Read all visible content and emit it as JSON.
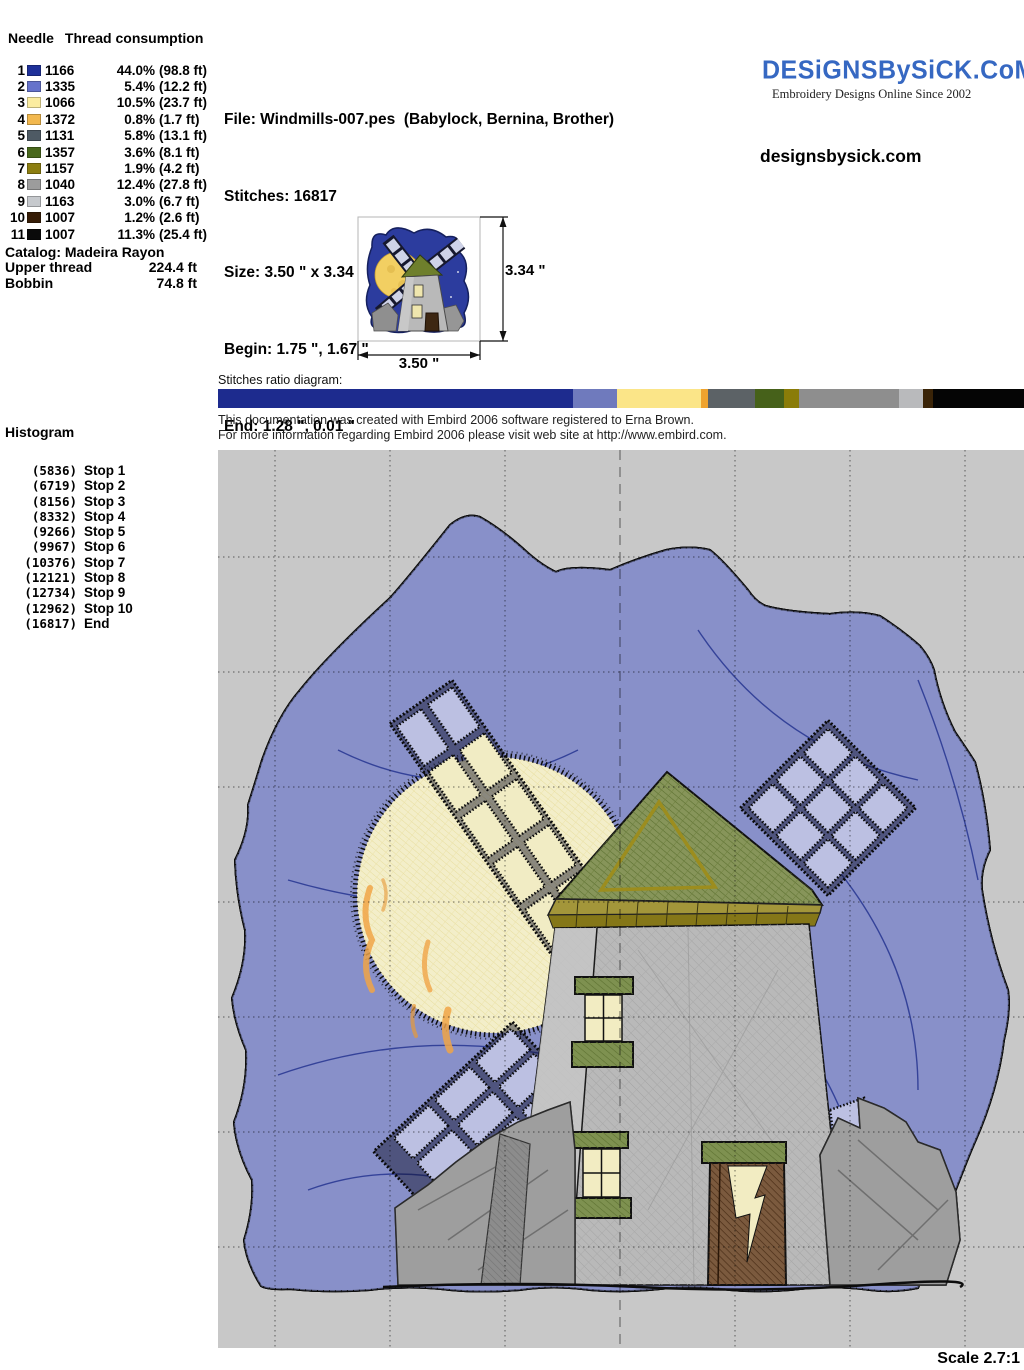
{
  "thread_table": {
    "col1": "Needle",
    "col2": "Thread consumption",
    "rows": [
      {
        "needle": "1",
        "color": "#1e3099",
        "code": "1166",
        "pct": "44.0%",
        "length": "(98.8 ft)"
      },
      {
        "needle": "2",
        "color": "#6673cb",
        "code": "1335",
        "pct": "5.4%",
        "length": "(12.2 ft)"
      },
      {
        "needle": "3",
        "color": "#fbeca0",
        "code": "1066",
        "pct": "10.5%",
        "length": "(23.7 ft)"
      },
      {
        "needle": "4",
        "color": "#f2b84e",
        "code": "1372",
        "pct": "0.8%",
        "length": "(1.7 ft)"
      },
      {
        "needle": "5",
        "color": "#4e5a64",
        "code": "1131",
        "pct": "5.8%",
        "length": "(13.1 ft)"
      },
      {
        "needle": "6",
        "color": "#49681c",
        "code": "1357",
        "pct": "3.6%",
        "length": "(8.1 ft)"
      },
      {
        "needle": "7",
        "color": "#8c7e10",
        "code": "1157",
        "pct": "1.9%",
        "length": "(4.2 ft)"
      },
      {
        "needle": "8",
        "color": "#9c9c9c",
        "code": "1040",
        "pct": "12.4%",
        "length": "(27.8 ft)"
      },
      {
        "needle": "9",
        "color": "#c6c9cd",
        "code": "1163",
        "pct": "3.0%",
        "length": "(6.7 ft)"
      },
      {
        "needle": "10",
        "color": "#361c06",
        "code": "1007",
        "pct": "1.2%",
        "length": "(2.6 ft)"
      },
      {
        "needle": "11",
        "color": "#0a0a0a",
        "code": "1007",
        "pct": "11.3%",
        "length": "(25.4 ft)"
      }
    ]
  },
  "catalog": {
    "title": "Catalog: Madeira Rayon",
    "upper_label": "Upper thread",
    "upper_value": "224.4 ft",
    "bobbin_label": "Bobbin",
    "bobbin_value": "74.8 ft"
  },
  "file_info": {
    "lines": [
      "File: Windmills-007.pes  (Babylock, Bernina, Brother)",
      "Stitches: 16817",
      "Size: 3.50 \" x 3.34 \"",
      "Begin: 1.75 \", 1.67 \"",
      "End: 1.28 \", 0.01 \"",
      "Start needle: 1",
      "Colors: 11/11 , Stops: 10",
      "Date: 12/31/2007"
    ]
  },
  "branding": {
    "logo_text": "DESiGNSBySiCK.CoM",
    "tagline": "Embroidery Designs Online Since 2002",
    "site": "designsbysick.com",
    "logo_color": "#3668c2"
  },
  "preview": {
    "height_label": "3.34 \"",
    "width_label": "3.50 \""
  },
  "ratio": {
    "label": "Stitches ratio diagram:",
    "segments": [
      {
        "color": "#1d2b8e",
        "pct": 44.0
      },
      {
        "color": "#6f7abd",
        "pct": 5.4
      },
      {
        "color": "#fbe588",
        "pct": 10.5
      },
      {
        "color": "#efa32f",
        "pct": 0.8
      },
      {
        "color": "#5c6266",
        "pct": 5.8
      },
      {
        "color": "#46611a",
        "pct": 3.6
      },
      {
        "color": "#8a7c08",
        "pct": 1.9
      },
      {
        "color": "#8e8e8e",
        "pct": 12.4
      },
      {
        "color": "#b9babc",
        "pct": 3.0
      },
      {
        "color": "#3a2408",
        "pct": 1.2
      },
      {
        "color": "#050505",
        "pct": 11.3
      }
    ]
  },
  "embird_note": {
    "lines": [
      "This documentation was created with Embird 2006 software registered to Erna Brown.",
      "For more information regarding Embird 2006 please visit web site at http://www.embird.com."
    ]
  },
  "histogram": {
    "title": "Histogram",
    "entries": [
      {
        "count": "(5836)",
        "label": "Stop 1"
      },
      {
        "count": "(6719)",
        "label": "Stop 2"
      },
      {
        "count": "(8156)",
        "label": "Stop 3"
      },
      {
        "count": "(8332)",
        "label": "Stop 4"
      },
      {
        "count": "(9266)",
        "label": "Stop 5"
      },
      {
        "count": "(9967)",
        "label": "Stop 6"
      },
      {
        "count": "(10376)",
        "label": "Stop 7"
      },
      {
        "count": "(12121)",
        "label": "Stop 8"
      },
      {
        "count": "(12734)",
        "label": "Stop 9"
      },
      {
        "count": "(12962)",
        "label": "Stop 10"
      },
      {
        "count": "(16817)",
        "label": "End"
      }
    ]
  },
  "scale_label": "Scale 2.7:1",
  "design": {
    "palette": {
      "background_gray": "#c8c8c8",
      "sky_blue": "#8890c9",
      "sky_hatch_navy": "#2c3a96",
      "outline_black": "#0d0d0d",
      "moon_yellow": "#f3eec9",
      "moon_streak_orange": "#f0a447",
      "blade_lavender": "#bcc0e2",
      "roof_green": "#87955a",
      "trim_olive": "#a3963a",
      "tower_gray": "#b9b9b9",
      "rock_gray": "#9e9e9e",
      "door_brown": "#7b5a3e",
      "window_light": "#f2ecc2",
      "sill_green": "#7e9150"
    }
  }
}
